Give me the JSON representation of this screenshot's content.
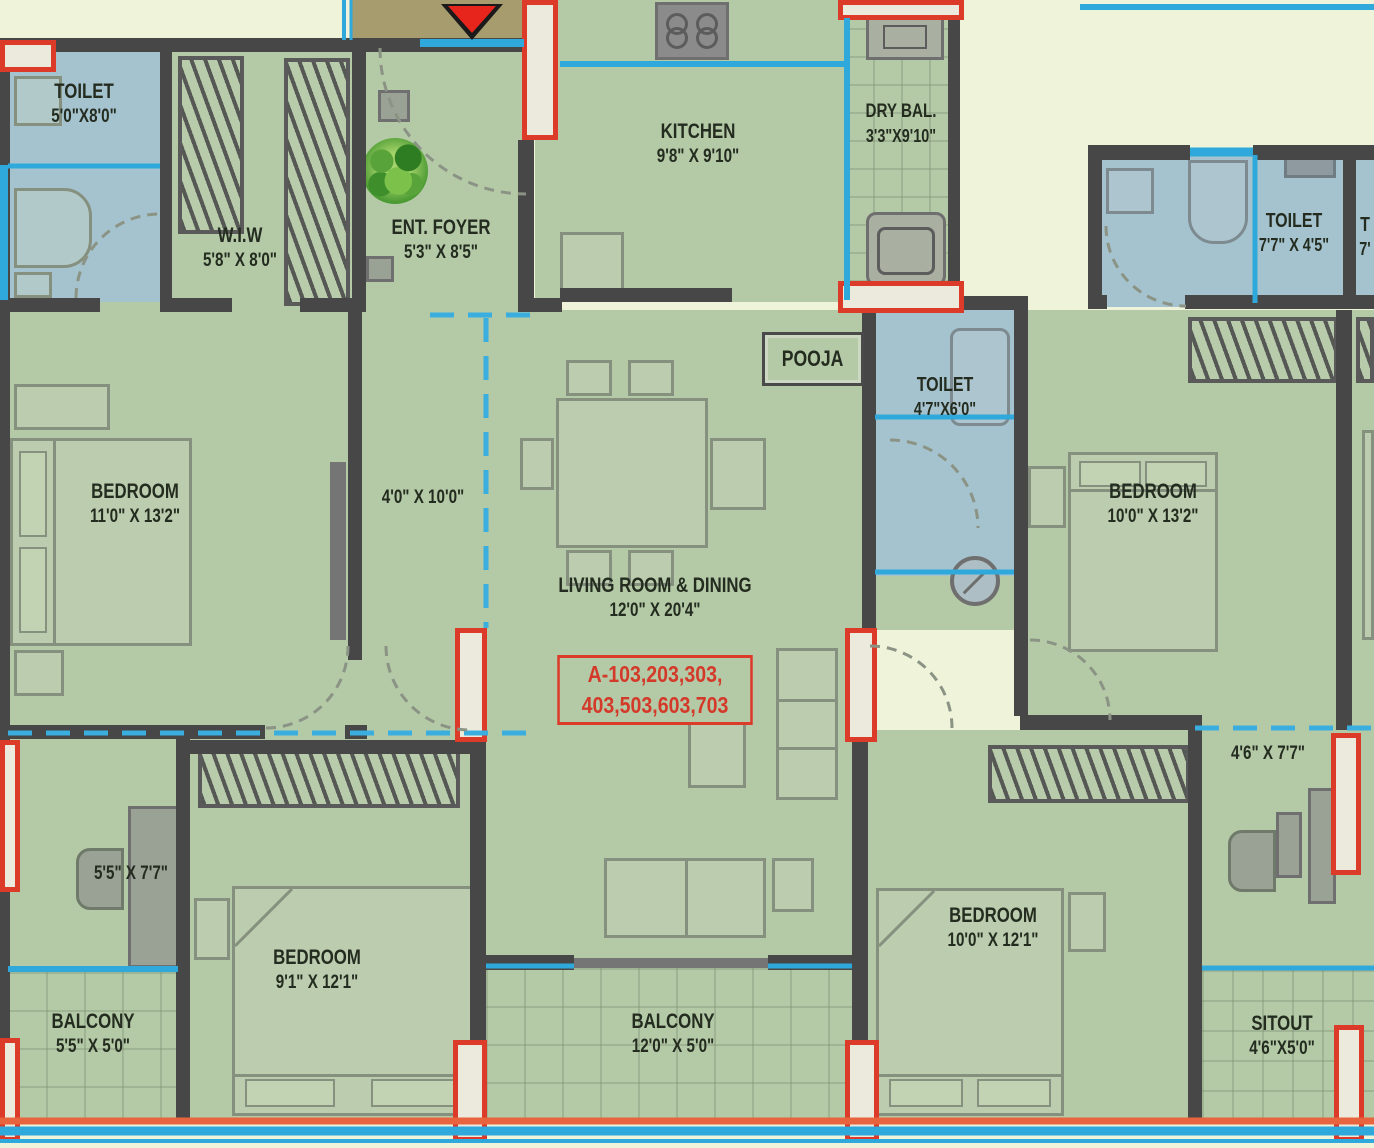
{
  "colors": {
    "room_green": "#b4caa7",
    "toilet_blue": "#a5c3ce",
    "background_cream": "#eef3da",
    "lobby_brown": "#a79c6e",
    "wall_gray": "#474747",
    "accent_red": "#dd3b2a",
    "window_cyan": "#2fa8dc",
    "label_text": "#242c20"
  },
  "unit_label": {
    "line1": "A-103,203,303,",
    "line2": "403,503,603,703"
  },
  "labels": {
    "toilet_tl": {
      "name": "TOILET",
      "dims": "5'0\"X8'0\""
    },
    "wiw": {
      "name": "W.I.W",
      "dims": "5'8\" X 8'0\""
    },
    "ent_foyer": {
      "name": "ENT. FOYER",
      "dims": "5'3\" X 8'5\""
    },
    "kitchen": {
      "name": "KITCHEN",
      "dims": "9'8\" X 9'10\""
    },
    "dry_bal": {
      "name": "DRY BAL.",
      "dims": "3'3\"X9'10\""
    },
    "pooja": {
      "name": "POOJA"
    },
    "toilet_mid": {
      "name": "TOILET",
      "dims": "4'7\"X6'0\""
    },
    "bedroom_left": {
      "name": "BEDROOM",
      "dims": "11'0\" X 13'2\""
    },
    "passage": {
      "dims": "4'0\" X 10'0\""
    },
    "living": {
      "name": "LIVING ROOM & DINING",
      "dims": "12'0\" X 20'4\""
    },
    "dress_left": {
      "dims": "5'5\" X 7'7\""
    },
    "bedroom_bl": {
      "name": "BEDROOM",
      "dims": "9'1\" X 12'1\""
    },
    "balcony_left": {
      "name": "BALCONY",
      "dims": "5'5\" X 5'0\""
    },
    "balcony_center": {
      "name": "BALCONY",
      "dims": "12'0\" X 5'0\""
    },
    "bedroom_right": {
      "name": "BEDROOM",
      "dims": "10'0\" X 13'2\""
    },
    "toilet_right": {
      "name": "TOILET",
      "dims": "7'7\" X 4'5\""
    },
    "toilet_partial": {
      "name": "T",
      "dims": "7'"
    },
    "bedroom_br": {
      "name": "BEDROOM",
      "dims": "10'0\" X 12'1\""
    },
    "study_right": {
      "dims": "4'6\" X 7'7\""
    },
    "sitout": {
      "name": "SITOUT",
      "dims": "4'6\"X5'0\""
    }
  }
}
